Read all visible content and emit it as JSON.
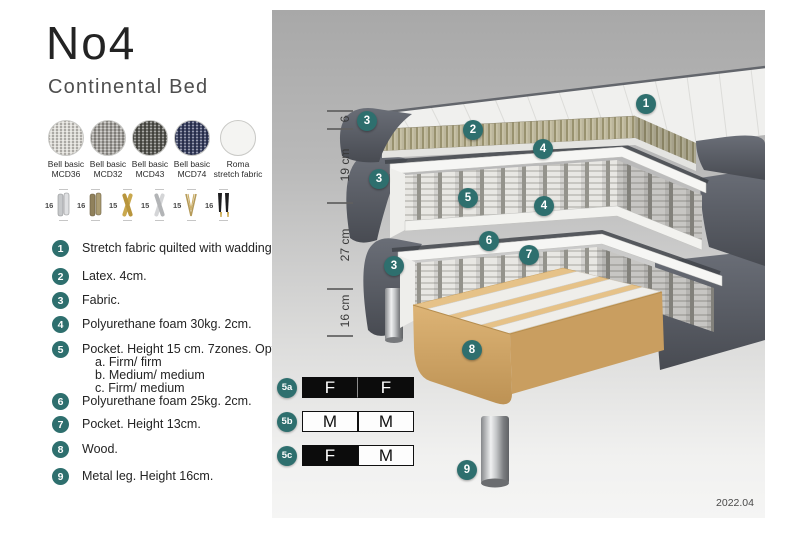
{
  "header": {
    "title": "No4",
    "subtitle": "Continental Bed"
  },
  "fabric_swatches": [
    {
      "line1": "Bell basic",
      "line2": "MCD36",
      "color": "#d9d7d1"
    },
    {
      "line1": "Bell basic",
      "line2": "MCD32",
      "color": "#a19f9a"
    },
    {
      "line1": "Bell basic",
      "line2": "MCD43",
      "color": "#54544e"
    },
    {
      "line1": "Bell basic",
      "line2": "MCD74",
      "color": "#333a5c"
    },
    {
      "line1": "Roma",
      "line2": "stretch fabric",
      "color": "#f4f4f2"
    }
  ],
  "leg_options": [
    {
      "height": "16",
      "style": "cylinder-silver"
    },
    {
      "height": "16",
      "style": "cylinder-bronze"
    },
    {
      "height": "15",
      "style": "cross-gold"
    },
    {
      "height": "15",
      "style": "cross-silver"
    },
    {
      "height": "15",
      "style": "hairpin-gold"
    },
    {
      "height": "16",
      "style": "tapered-black"
    }
  ],
  "legend": {
    "items": [
      {
        "num": "1",
        "text": "Stretch fabric quilted with wadding."
      },
      {
        "num": "2",
        "text": "Latex. 4cm."
      },
      {
        "num": "3",
        "text": "Fabric."
      },
      {
        "num": "4",
        "text": "Polyurethane foam 30kg. 2cm."
      },
      {
        "num": "5",
        "text": "Pocket. Height 15 cm. 7zones. Option:",
        "options": {
          "a": "a. Firm/ firm",
          "b": "b. Medium/ medium",
          "c": "c. Firm/ medium"
        }
      },
      {
        "num": "6",
        "text": "Polyurethane foam 25kg. 2cm."
      },
      {
        "num": "7",
        "text": "Pocket. Height 13cm."
      },
      {
        "num": "8",
        "text": "Wood."
      },
      {
        "num": "9",
        "text": "Metal leg. Height 16cm."
      }
    ]
  },
  "diagram": {
    "measurements": [
      {
        "label": "6"
      },
      {
        "label": "19 cm"
      },
      {
        "label": "27 cm"
      },
      {
        "label": "16 cm"
      }
    ],
    "markers": [
      {
        "label": "1"
      },
      {
        "label": "3"
      },
      {
        "label": "2"
      },
      {
        "label": "4"
      },
      {
        "label": "3"
      },
      {
        "label": "5"
      },
      {
        "label": "4"
      },
      {
        "label": "6"
      },
      {
        "label": "7"
      },
      {
        "label": "3"
      },
      {
        "label": "8"
      },
      {
        "label": "9"
      }
    ],
    "firmness": [
      {
        "id": "5a",
        "cells": [
          {
            "letter": "F",
            "fill": "black"
          },
          {
            "letter": "F",
            "fill": "black"
          }
        ]
      },
      {
        "id": "5b",
        "cells": [
          {
            "letter": "M",
            "fill": "white"
          },
          {
            "letter": "M",
            "fill": "white"
          }
        ]
      },
      {
        "id": "5c",
        "cells": [
          {
            "letter": "F",
            "fill": "black"
          },
          {
            "letter": "M",
            "fill": "white"
          }
        ]
      }
    ],
    "date": "2022.04"
  },
  "colors": {
    "accent_teal": "#2e6f6e",
    "fabric_dark": "#565a62",
    "latex": "#b5af94",
    "wood": "#e2bd80"
  }
}
